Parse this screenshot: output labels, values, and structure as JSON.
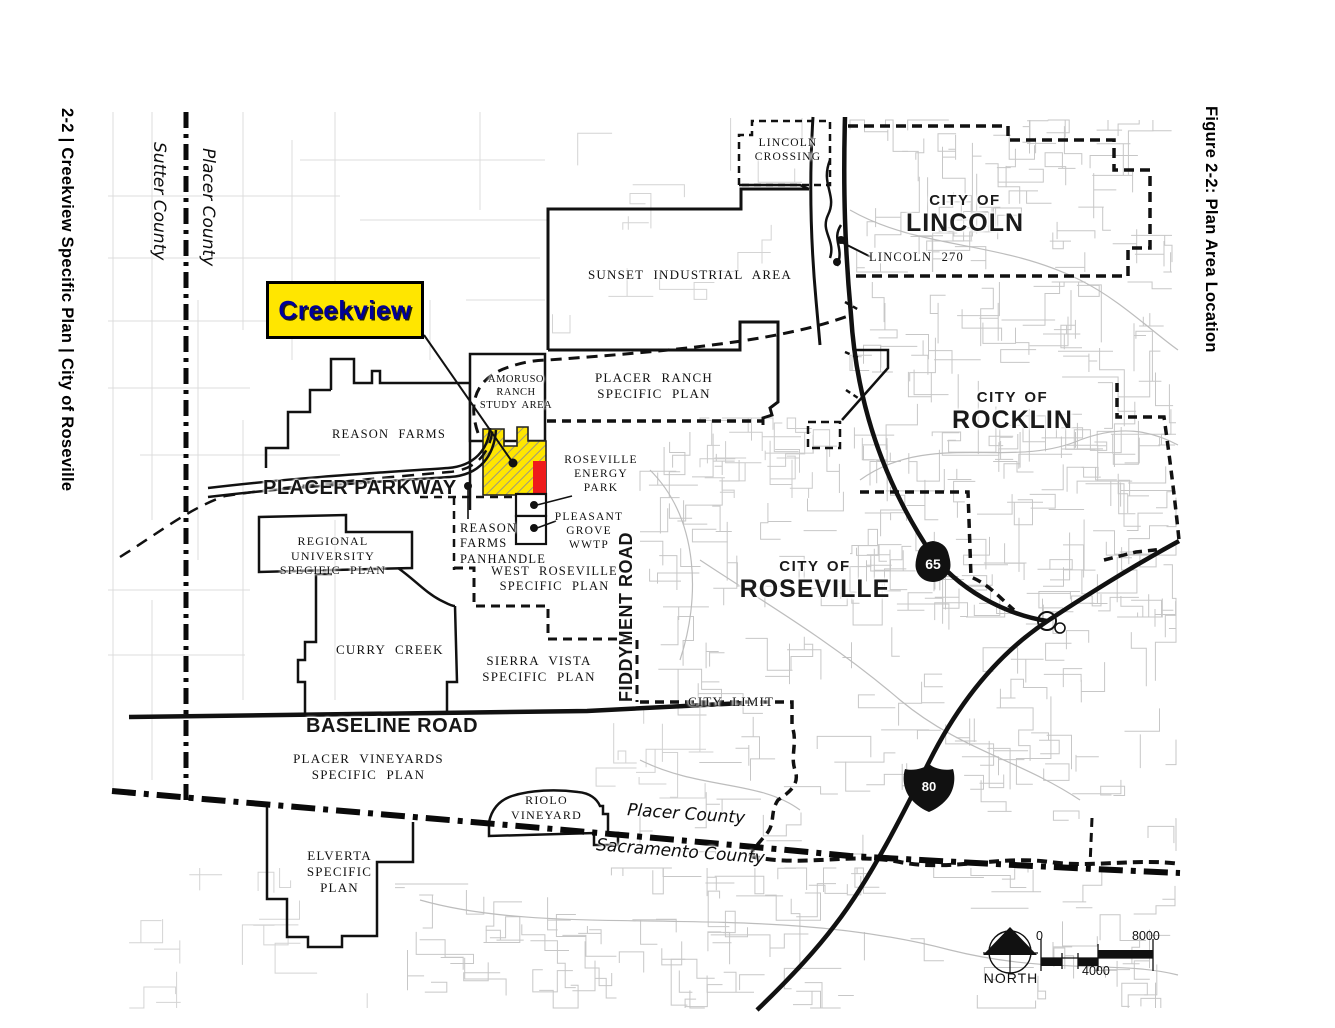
{
  "figure": {
    "side_caption_left": "2-2 | Creekview Specific Plan | City of Roseville",
    "side_caption_right": "Figure 2-2:  Plan Area Location"
  },
  "map": {
    "colors": {
      "plan_yellow": "#FFE600",
      "callout_yellow": "#FFE600",
      "callout_text": "#000099",
      "energy_red": "#EE1C1C"
    },
    "county_labels": {
      "sutter_vertical": "Sutter County",
      "placer_vertical": "Placer County",
      "placer_diagonal": "Placer County",
      "sacramento_diagonal": "Sacramento County"
    },
    "city_labels": {
      "lincoln": {
        "line1": "CITY OF",
        "line2": "LINCOLN"
      },
      "rocklin": {
        "line1": "CITY OF",
        "line2": "ROCKLIN"
      },
      "roseville": {
        "line1": "CITY OF",
        "line2": "ROSEVILLE"
      }
    },
    "road_labels": {
      "placer_parkway": "PLACER PARKWAY",
      "baseline_road": "BASELINE ROAD",
      "fiddyment_road": "FIDDYMENT ROAD"
    },
    "highway_shields": {
      "route_65": "65",
      "interstate_80": "80"
    },
    "callout": {
      "creekview": "Creekview"
    },
    "area_labels": {
      "lincoln_crossing": [
        "LINCOLN",
        "CROSSING"
      ],
      "lincoln_270": [
        "LINCOLN 270"
      ],
      "sunset_industrial": [
        "SUNSET INDUSTRIAL AREA"
      ],
      "placer_ranch": [
        "PLACER RANCH",
        "SPECIFIC PLAN"
      ],
      "amoruso": [
        "AMORUSO",
        "RANCH",
        "STUDY AREA"
      ],
      "reason_farms": [
        "REASON FARMS"
      ],
      "roseville_energy": [
        "ROSEVILLE",
        "ENERGY",
        "PARK"
      ],
      "pleasant_grove": [
        "PLEASANT",
        "GROVE",
        "WWTP"
      ],
      "reason_farms_panhandle": [
        "REASON",
        "FARMS",
        "PANHANDLE"
      ],
      "west_roseville": [
        "WEST ROSEVILLE",
        "SPECIFIC PLAN"
      ],
      "regional_university": [
        "REGIONAL UNIVERSITY",
        "SPECIFIC PLAN"
      ],
      "curry_creek": [
        "CURRY CREEK"
      ],
      "sierra_vista": [
        "SIERRA VISTA",
        "SPECIFIC PLAN"
      ],
      "city_limit": [
        "CITY LIMIT"
      ],
      "placer_vineyards": [
        "PLACER VINEYARDS",
        "SPECIFIC PLAN"
      ],
      "riolo_vineyard": [
        "RIOLO",
        "VINEYARD"
      ],
      "elverta": [
        "ELVERTA",
        "SPECIFIC",
        "PLAN"
      ]
    },
    "legend": {
      "north": "NORTH",
      "scale_ticks": [
        "0",
        "4000",
        "8000"
      ]
    }
  }
}
